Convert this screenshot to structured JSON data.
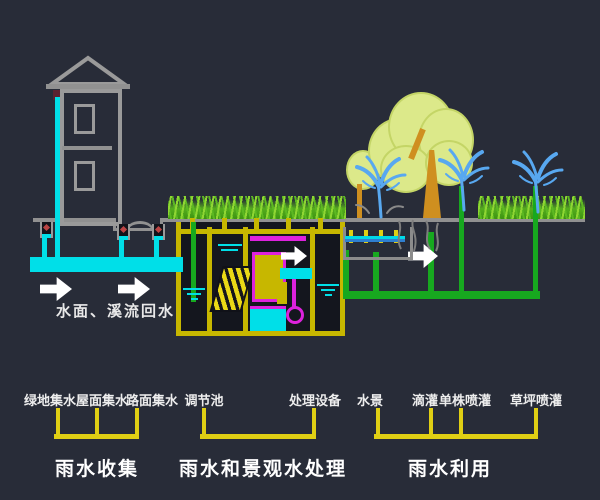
{
  "colors": {
    "background": "#282c38",
    "ground_gray": "#919191",
    "rain_pipe_cyan": "#00dfe8",
    "facility_yellow": "#c7b700",
    "legend_bracket_yellow": "#e0cf14",
    "irrigation_green": "#17a81f",
    "equipment_magenta": "#dd22dd",
    "grass_green": "#5cb822",
    "tree_foliage": "#dce98a",
    "tree_trunk": "#cf8f1f",
    "spray_blue": "#58a8f0",
    "text_white": "#ffffff"
  },
  "annotations": {
    "return_water": "水面、溪流回水"
  },
  "legend": {
    "groups": [
      {
        "title": "雨水收集",
        "items": [
          {
            "label": "绿地集水"
          },
          {
            "label": "屋面集水"
          },
          {
            "label": "路面集水"
          }
        ]
      },
      {
        "title": "雨水和景观水处理",
        "items": [
          {
            "label": "调节池"
          },
          {
            "label": "处理设备"
          }
        ]
      },
      {
        "title": "雨水利用",
        "items": [
          {
            "label": "水景"
          },
          {
            "label": "滴灌"
          },
          {
            "label": "单株喷灌"
          },
          {
            "label": "草坪喷灌"
          }
        ]
      }
    ]
  }
}
